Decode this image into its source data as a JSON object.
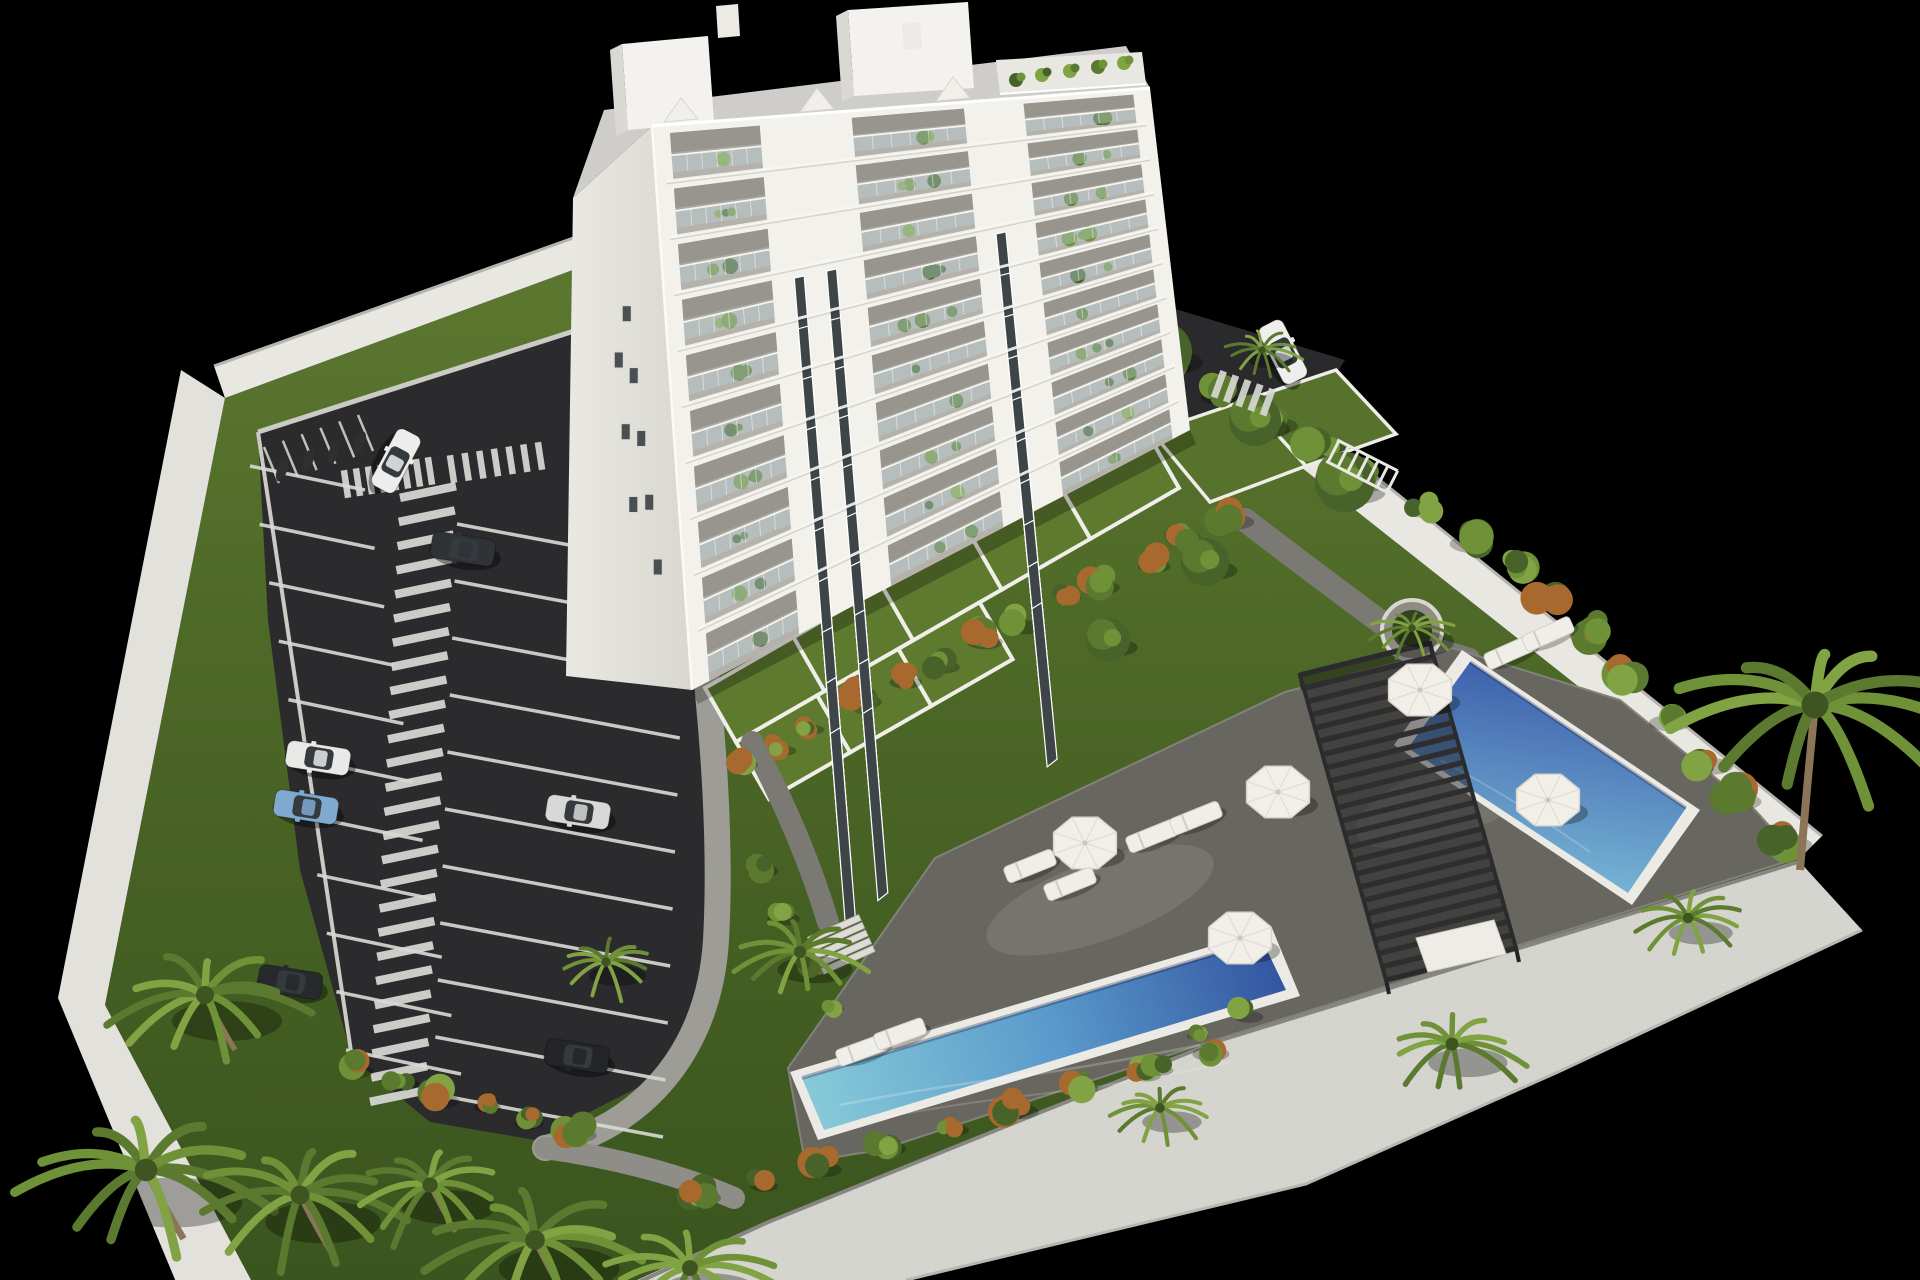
{
  "meta": {
    "description": "aerial-3d-render-of-apartment-complex",
    "visible_text": []
  },
  "palette": {
    "background": "#000000",
    "lawn_light": "#5e7a31",
    "lawn_mid": "#4a6525",
    "lawn_dark": "#3a551e",
    "terrace_grass": "#5d7a2f",
    "asphalt": "#2b2b2e",
    "marking_white": "#d9d9d5",
    "sidewalk": "#9e9c96",
    "garden_path": "#7b7973",
    "wall_light": "#e8e7e1",
    "wall_mid": "#dcdbd5",
    "wall_edge": "#b5b4ae",
    "deck": "#6c6b64",
    "deck_light": "#82817a",
    "pool_rim": "#eceae4",
    "pool_deep": "#31519e",
    "pool_mid": "#5a9acb",
    "pool_shallow": "#86cad8",
    "pergola": "#2e2e30",
    "building_facade": "#f2f1eb",
    "building_gable": "#e2e1da",
    "balcony_recess": "#b4b2ab",
    "balcony_shade": "#a5a39b",
    "glass": "#bacdd4",
    "window_dark": "#3e4548",
    "roof": "#d5d4d0",
    "green1": "#48632a",
    "green2": "#5b7a2f",
    "green3": "#6f9138",
    "green4": "#82a344",
    "autumn_orange": "#a8692f",
    "trunk": "#8a7557",
    "umbrella": "#f1efe8",
    "lounger": "#efeee8"
  },
  "scene": {
    "canvas": {
      "w": 1920,
      "h": 1280
    },
    "building": {
      "floors": 10,
      "balcony_strips": [
        [
          0.035,
          0.215
        ],
        [
          0.4,
          0.625
        ],
        [
          0.745,
          0.965
        ]
      ],
      "window_columns": [
        0.26,
        0.325,
        0.665
      ],
      "gable_windows": [
        [
          0.6,
          0.3
        ],
        [
          0.645,
          0.42
        ],
        [
          0.69,
          0.54
        ],
        [
          0.735,
          0.66
        ],
        [
          0.78,
          0.78
        ],
        [
          0.5,
          0.38
        ],
        [
          0.545,
          0.52
        ],
        [
          0.59,
          0.66
        ]
      ],
      "roof_plants": [
        [
          1016,
          80
        ],
        [
          1042,
          75
        ],
        [
          1070,
          71
        ],
        [
          1098,
          67
        ],
        [
          1124,
          63
        ]
      ]
    },
    "parking": {
      "left_stalls": 11,
      "right_stalls": 11,
      "zebra_bars": 26,
      "moto_dividers": 6,
      "crosswalk_a_bars": 8,
      "crosswalk_b_bars": 7,
      "stop_dashes": 4
    },
    "cars": [
      {
        "x": 318,
        "y": 758,
        "angle": 9,
        "color": "#e9e9e8"
      },
      {
        "x": 306,
        "y": 807,
        "angle": 9,
        "color": "#7fa9cf"
      },
      {
        "x": 290,
        "y": 982,
        "angle": 9,
        "color": "#27292c"
      },
      {
        "x": 463,
        "y": 549,
        "angle": 9,
        "color": "#303336"
      },
      {
        "x": 578,
        "y": 812,
        "angle": 9,
        "color": "#d8d8d6"
      },
      {
        "x": 577,
        "y": 1056,
        "angle": 9,
        "color": "#232528"
      },
      {
        "x": 396,
        "y": 461,
        "angle": 118,
        "color": "#ededec"
      },
      {
        "x": 1283,
        "y": 352,
        "angle": 63,
        "color": "#eeeeec"
      }
    ],
    "palms": [
      {
        "x": 205,
        "y": 995,
        "r": 100
      },
      {
        "x": 146,
        "y": 1170,
        "r": 125
      },
      {
        "x": 300,
        "y": 1195,
        "r": 105
      },
      {
        "x": 430,
        "y": 1185,
        "r": 85
      },
      {
        "x": 535,
        "y": 1240,
        "r": 110
      },
      {
        "x": 690,
        "y": 1268,
        "r": 88
      },
      {
        "x": 606,
        "y": 962,
        "r": 52
      },
      {
        "x": 800,
        "y": 952,
        "r": 68
      },
      {
        "x": 1452,
        "y": 1044,
        "r": 72
      },
      {
        "x": 1160,
        "y": 1108,
        "r": 54
      },
      {
        "x": 1688,
        "y": 918,
        "r": 58
      },
      {
        "x": 1262,
        "y": 350,
        "r": 40
      },
      {
        "x": 1815,
        "y": 705,
        "r": 150,
        "trunk": true
      }
    ],
    "planter_palm": {
      "x": 1412,
      "y": 628,
      "r": 42
    },
    "umbrellas": [
      [
        1420,
        690
      ],
      [
        1278,
        792
      ],
      [
        1085,
        843
      ],
      [
        1548,
        800
      ],
      [
        1240,
        938
      ]
    ],
    "loungers": [
      [
        1152,
        836,
        -22
      ],
      [
        1196,
        818,
        -22
      ],
      [
        1030,
        866,
        -22
      ],
      [
        1070,
        884,
        -22
      ],
      [
        862,
        1050,
        -20
      ],
      [
        900,
        1034,
        -20
      ],
      [
        1510,
        652,
        -24
      ],
      [
        1548,
        634,
        -24
      ]
    ],
    "trees": [
      [
        1162,
        352,
        30
      ],
      [
        1255,
        420,
        26
      ],
      [
        1345,
        482,
        30
      ],
      [
        1205,
        562,
        24
      ],
      [
        1108,
        640,
        22
      ]
    ],
    "bush_rows": [
      {
        "from": [
          732,
          762
        ],
        "to": [
          1225,
          516
        ],
        "n": 13,
        "r": 17,
        "mix": true
      },
      {
        "from": [
          692,
          1196
        ],
        "to": [
          1200,
          1052
        ],
        "n": 9,
        "r": 19,
        "mix": true
      },
      {
        "from": [
          1118,
          332
        ],
        "to": [
          1520,
          564
        ],
        "n": 9,
        "r": 22,
        "mix": false
      },
      {
        "from": [
          1548,
          588
        ],
        "to": [
          1778,
          838
        ],
        "n": 7,
        "r": 22,
        "mix": true
      },
      {
        "from": [
          354,
          1066
        ],
        "to": [
          568,
          1128
        ],
        "n": 6,
        "r": 17,
        "mix": true
      },
      {
        "from": [
          758,
          864
        ],
        "to": [
          830,
          1008
        ],
        "n": 4,
        "r": 15,
        "mix": false
      },
      {
        "from": [
          1238,
          1012
        ],
        "to": [
          1160,
          1062
        ],
        "n": 3,
        "r": 16,
        "mix": false
      }
    ],
    "terraces": {
      "row1_plots": 5,
      "row2_plots": 3
    },
    "stairs_steps": 5,
    "bike_rack_rungs": 7,
    "pergola_slats": 24
  }
}
